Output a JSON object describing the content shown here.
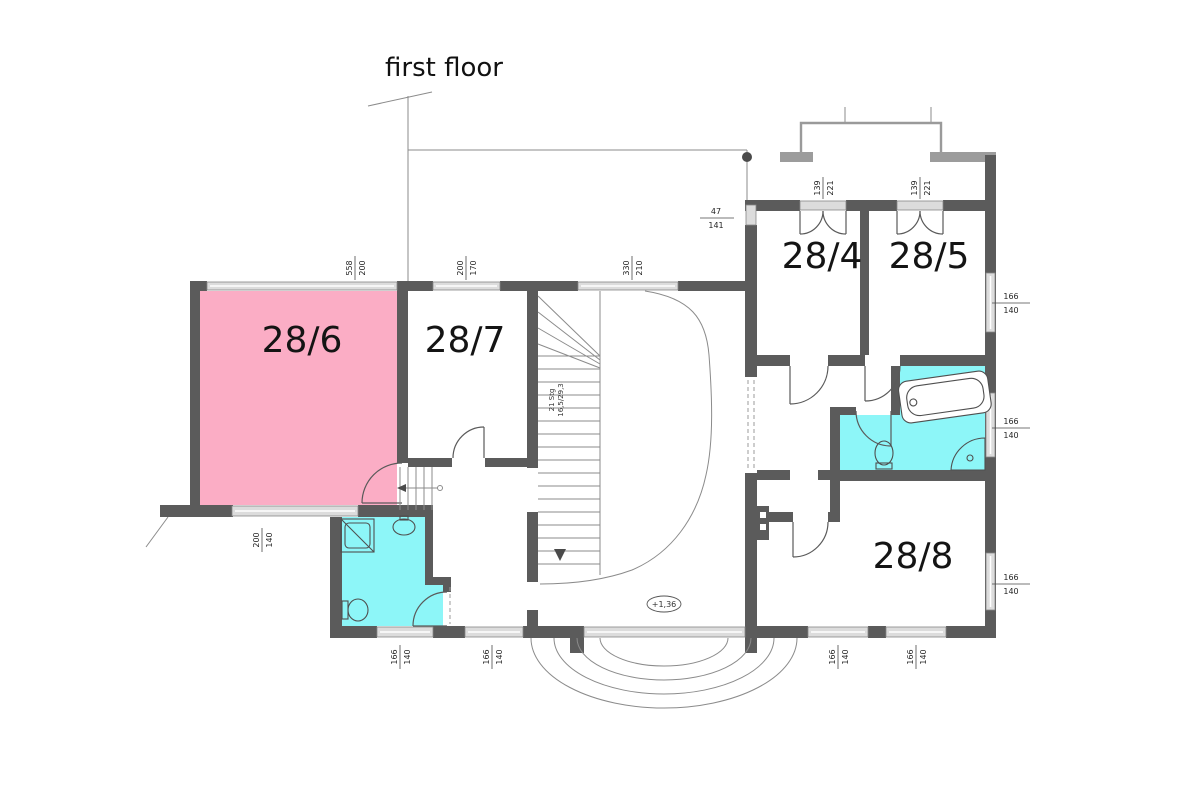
{
  "title": "first floor",
  "rooms": {
    "r284": {
      "label": "28/4"
    },
    "r285": {
      "label": "28/5"
    },
    "r286": {
      "label": "28/6"
    },
    "r287": {
      "label": "28/7"
    },
    "r288": {
      "label": "28/8"
    }
  },
  "staircase": {
    "label_line1": "21 Stg",
    "label_line2": "16,5/29,3"
  },
  "elevation_marker": {
    "value": "+1,36"
  },
  "dims": {
    "w286_top": {
      "a": "558",
      "b": "200"
    },
    "w287_top": {
      "a": "200",
      "b": "170"
    },
    "wstair_top": {
      "a": "330",
      "b": "210"
    },
    "door284": {
      "a": "139",
      "b": "221"
    },
    "door285": {
      "a": "139",
      "b": "221"
    },
    "w_small_left": {
      "a": "47",
      "b": "141"
    },
    "w285_right": {
      "a": "166",
      "b": "140"
    },
    "wbath_right": {
      "a": "166",
      "b": "140"
    },
    "w288_right": {
      "a": "166",
      "b": "140"
    },
    "w286_bottom": {
      "a": "200",
      "b": "140"
    },
    "wbathL_bottom": {
      "a": "166",
      "b": "140"
    },
    "wcorr_bottom": {
      "a": "166",
      "b": "140"
    },
    "w288_bottom1": {
      "a": "166",
      "b": "140"
    },
    "w288_bottom2": {
      "a": "166",
      "b": "140"
    }
  },
  "colors": {
    "pink": "#fbadc5",
    "cyan": "#8df6f8",
    "wall": "#5b5b5b",
    "wall_light": "#9c9c9c",
    "window_fill": "#dcdcdc"
  }
}
